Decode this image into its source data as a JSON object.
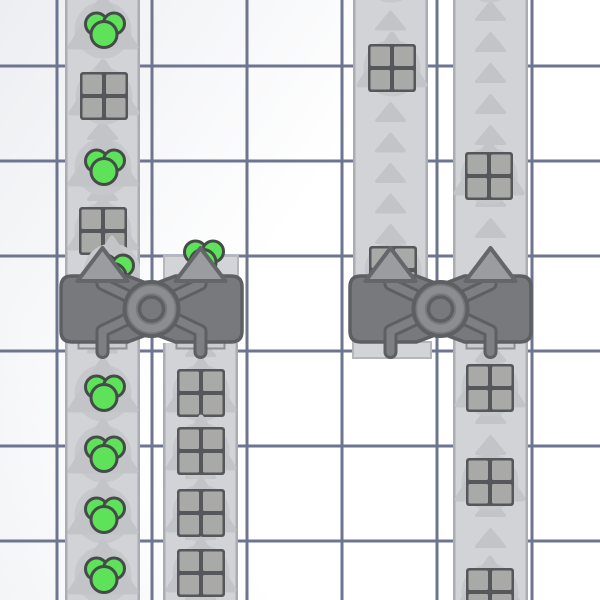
{
  "app": {
    "kind": "factory-game-viewport",
    "visible_text": ""
  },
  "canvas": {
    "width": 600,
    "height": 600
  },
  "scene": {
    "palette": {
      "bg": "#ffffff",
      "sheen": "#e9ebef",
      "grid_line": "#6d7590",
      "grid_opacity": 0.05,
      "belt_fill": "#d2d3d6",
      "belt_edge": "#abadb2",
      "belt_arrow": "#c3c4c8",
      "item_shadow": "#c7c8cc",
      "pad_fill": "#d3d4d7",
      "pad_edge": "#b6b7bc",
      "machine_fill": "#77797d",
      "machine_outline": "#5d5f63",
      "tube_fill": "#7d7f83",
      "ring_band": "#8b8d91",
      "machine_arrow_fill": "#9a9ca0",
      "machine_arrow_outline": "#64666a",
      "slot_fill": "#cbccd0",
      "slot_edge": "#8e9094",
      "square_fill": "#a9aaa7",
      "square_outline": "#55575a",
      "green_fill": "#5de25a",
      "green_outline": "#454b48"
    },
    "grid": {
      "pitch": 95,
      "offset_x": 57,
      "offset_y": 66,
      "line_width": 3
    },
    "belts": [
      {
        "name": "conveyor-belt-left-outer",
        "x": 65,
        "width": 75,
        "segments": [
          [
            0,
            600
          ]
        ],
        "arrow_start": 8,
        "arrow_pitch": 30.5
      },
      {
        "name": "conveyor-belt-left-inner",
        "x": 163,
        "width": 75,
        "segments": [
          [
            343,
            600
          ]
        ],
        "arrow_start": 347,
        "arrow_pitch": 30.5
      },
      {
        "name": "conveyor-belt-right-inner",
        "x": 353,
        "width": 75,
        "segments": [
          [
            0,
            278
          ]
        ],
        "arrow_start": 20.5,
        "arrow_pitch": 30.5
      },
      {
        "name": "conveyor-belt-right-outer",
        "x": 453,
        "width": 75,
        "segments": [
          [
            0,
            600
          ]
        ],
        "arrow_start": 11,
        "arrow_pitch": 31
      }
    ],
    "belt_style": {
      "edge_w": 2.5,
      "arrow_hw": 14,
      "arrow_hh": 8.5
    },
    "pads": [
      {
        "name": "output-pad",
        "x": 164,
        "y": 256,
        "width": 74,
        "height": 22
      },
      {
        "name": "input-pad",
        "x": 353,
        "y": 342,
        "width": 78,
        "height": 16
      }
    ],
    "items": [
      {
        "type": "green",
        "x": 103,
        "y": 30,
        "belt": 0
      },
      {
        "type": "square",
        "x": 104,
        "y": 96,
        "belt": 0
      },
      {
        "type": "green",
        "x": 103,
        "y": 167,
        "belt": 0
      },
      {
        "type": "square",
        "x": 103,
        "y": 231,
        "belt": 0
      },
      {
        "type": "green",
        "x": 112,
        "y": 272,
        "belt": 0
      },
      {
        "type": "green",
        "x": 103,
        "y": 393,
        "belt": 0
      },
      {
        "type": "green",
        "x": 103,
        "y": 454,
        "belt": 0
      },
      {
        "type": "green",
        "x": 103,
        "y": 515,
        "belt": 0
      },
      {
        "type": "green",
        "x": 103,
        "y": 575,
        "belt": 0
      },
      {
        "type": "green",
        "x": 202,
        "y": 258,
        "belt": 1,
        "arrow": false
      },
      {
        "type": "square",
        "x": 201,
        "y": 393,
        "belt": 1
      },
      {
        "type": "square",
        "x": 201,
        "y": 451,
        "belt": 1
      },
      {
        "type": "square",
        "x": 201,
        "y": 513,
        "belt": 1
      },
      {
        "type": "square",
        "x": 201,
        "y": 573,
        "belt": 1
      },
      {
        "type": "square",
        "x": 391,
        "y": -26,
        "belt": 2
      },
      {
        "type": "square",
        "x": 392,
        "y": 68,
        "belt": 2
      },
      {
        "type": "square",
        "x": 393,
        "y": 270,
        "belt": 2
      },
      {
        "type": "square",
        "x": 490,
        "y": -26,
        "belt": 3
      },
      {
        "type": "square",
        "x": 489,
        "y": 176,
        "belt": 3
      },
      {
        "type": "square",
        "x": 490,
        "y": 388,
        "belt": 3
      },
      {
        "type": "square",
        "x": 490,
        "y": 482,
        "belt": 3
      },
      {
        "type": "square",
        "x": 490,
        "y": 592,
        "belt": 3
      }
    ],
    "item_style": {
      "shadow_r": 28.5,
      "big_arrow": {
        "hw": 33,
        "up": 34,
        "down": 17
      },
      "square": {
        "half": 24,
        "outer_rx": 3,
        "cell": 19.5,
        "cell_gap_off": 2,
        "cell_rx": 1.5
      },
      "green": {
        "circles": [
          [
            -6.5,
            -6,
            11
          ],
          [
            11,
            -6.5,
            10.5
          ],
          [
            1,
            4.5,
            13
          ]
        ],
        "stroke_w": 3
      }
    },
    "machines": [
      {
        "name": "balancer-machine-left",
        "x": 61,
        "y": 276,
        "width": 181,
        "height": 66,
        "tiles": [
          102.5,
          200.5
        ],
        "bottom_slots": [
          0,
          1
        ]
      },
      {
        "name": "balancer-machine-right",
        "x": 350,
        "y": 276,
        "width": 181,
        "height": 66,
        "tiles": [
          390.5,
          490.5
        ],
        "bottom_slots": [
          1
        ]
      }
    ],
    "machine_style": {
      "corner": 11,
      "notch_hw": 24,
      "notch_d": 9,
      "outline_w": 3.5,
      "tube_w": 14,
      "tube_inner_w": 8,
      "bend_y": 331,
      "stub_end_y": 352,
      "diag_top_y": 284,
      "tube_top_y": 277,
      "arrow": {
        "hw": 25,
        "tip_y": 248,
        "base_y": 281,
        "stroke_w": 4
      },
      "ring": {
        "r": 27,
        "rim_w": 4,
        "band_r": 19.5,
        "band_w": 7.5,
        "inner_r": 12,
        "inner_w": 3.5
      },
      "slot": {
        "w": 48,
        "h": 7,
        "y": 341.5,
        "stroke_w": 2
      }
    },
    "sheen": {
      "top_left": {
        "x1": 0,
        "y1": 0,
        "x2": 300,
        "y2": 210,
        "opacity": 0.85
      },
      "bottom_left": {
        "x1": 0,
        "y1": 600,
        "x2": 150,
        "y2": 460,
        "opacity": 0.5
      }
    }
  }
}
